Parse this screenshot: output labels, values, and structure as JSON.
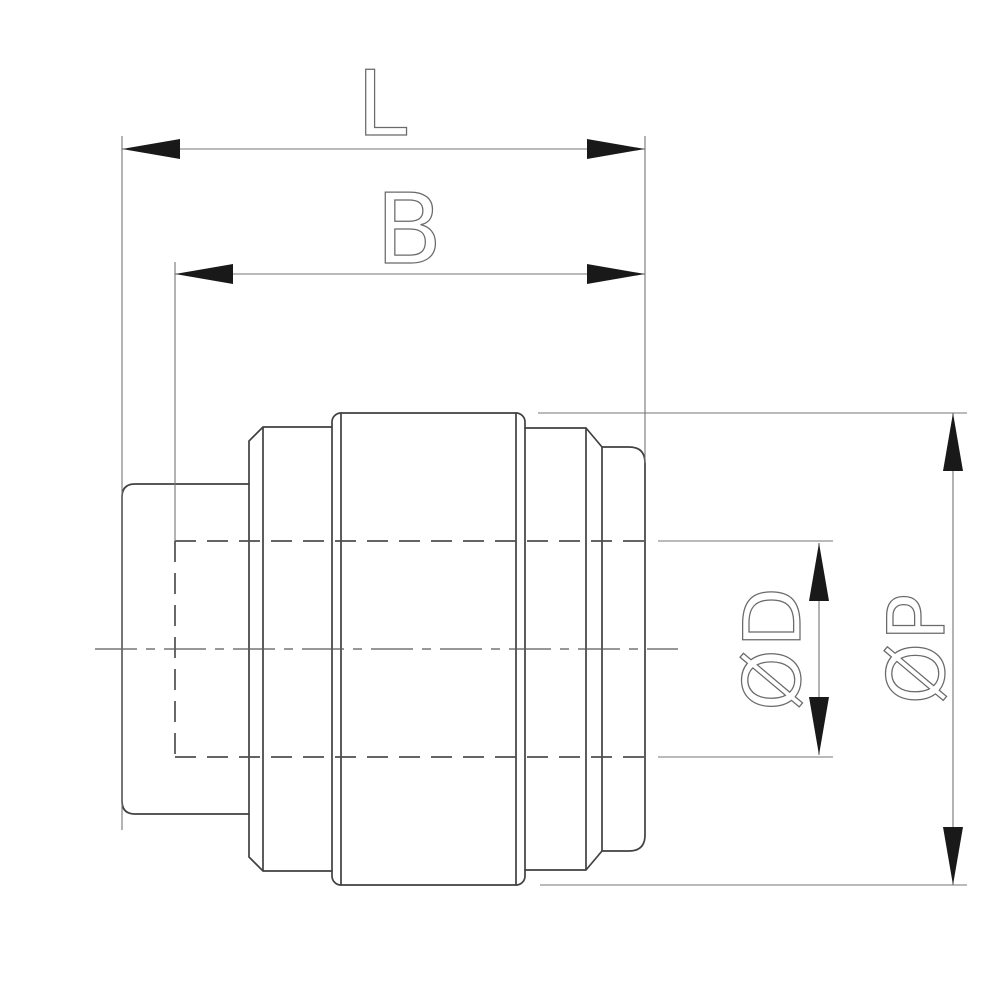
{
  "drawing": {
    "kind": "technical-drawing",
    "subject": "push-fit pipe fitting end cap, side section view with dimensions",
    "background_color": "#ffffff",
    "body_line_color": "#414141",
    "hidden_line_color": "#4f4f4f",
    "centerline_color": "#5a5a5a",
    "dim_line_color": "#757575",
    "arrow_color": "#191919",
    "label_color": "#6a6a6a",
    "labels": {
      "overall_length": "L",
      "body_length": "B",
      "bore_diameter": "ØD",
      "outer_diameter": "ØP"
    }
  }
}
